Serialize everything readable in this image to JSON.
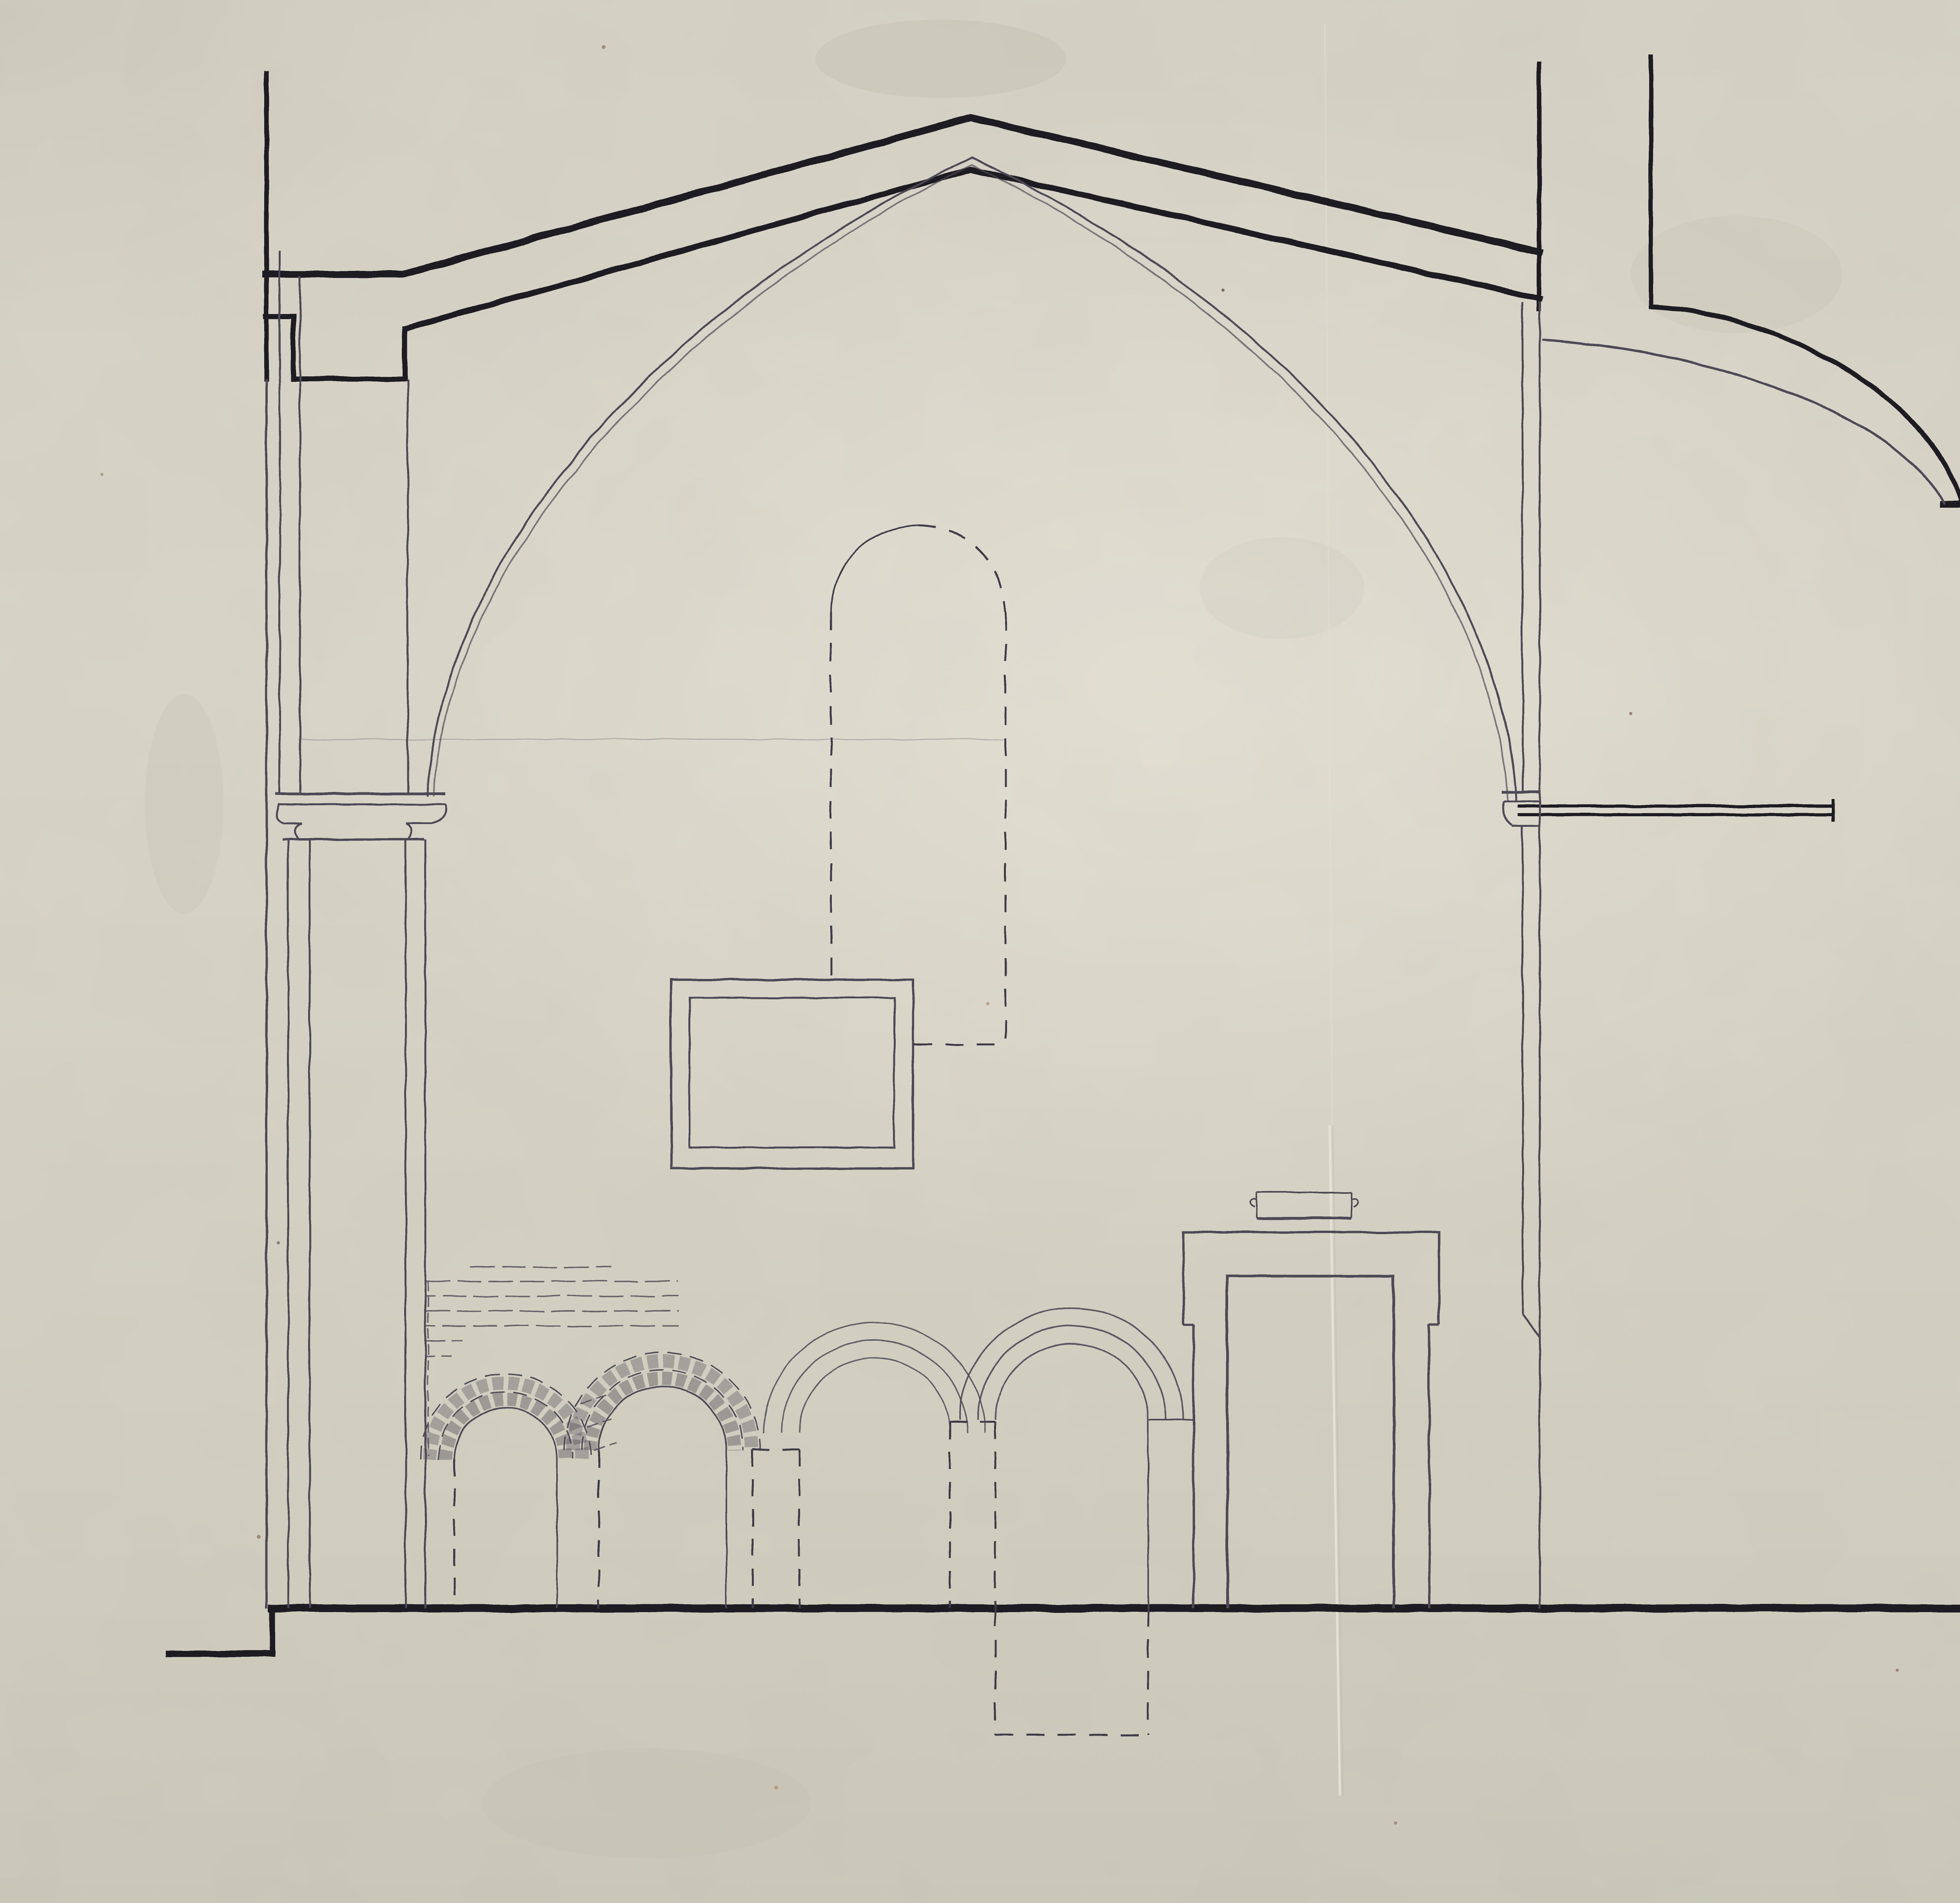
{
  "stamp": {
    "line1": "I. H. A. Sz. i T. F. Wr.",
    "number_label": "szám.",
    "number": "1026/8",
    "dots": "·········"
  },
  "palette": {
    "paper": "#d7d4c8",
    "ink": "#1c1b22",
    "pencil": "#4e4956",
    "stamp_violet": "#483da0",
    "handwritten_ink": "#2b2468"
  }
}
